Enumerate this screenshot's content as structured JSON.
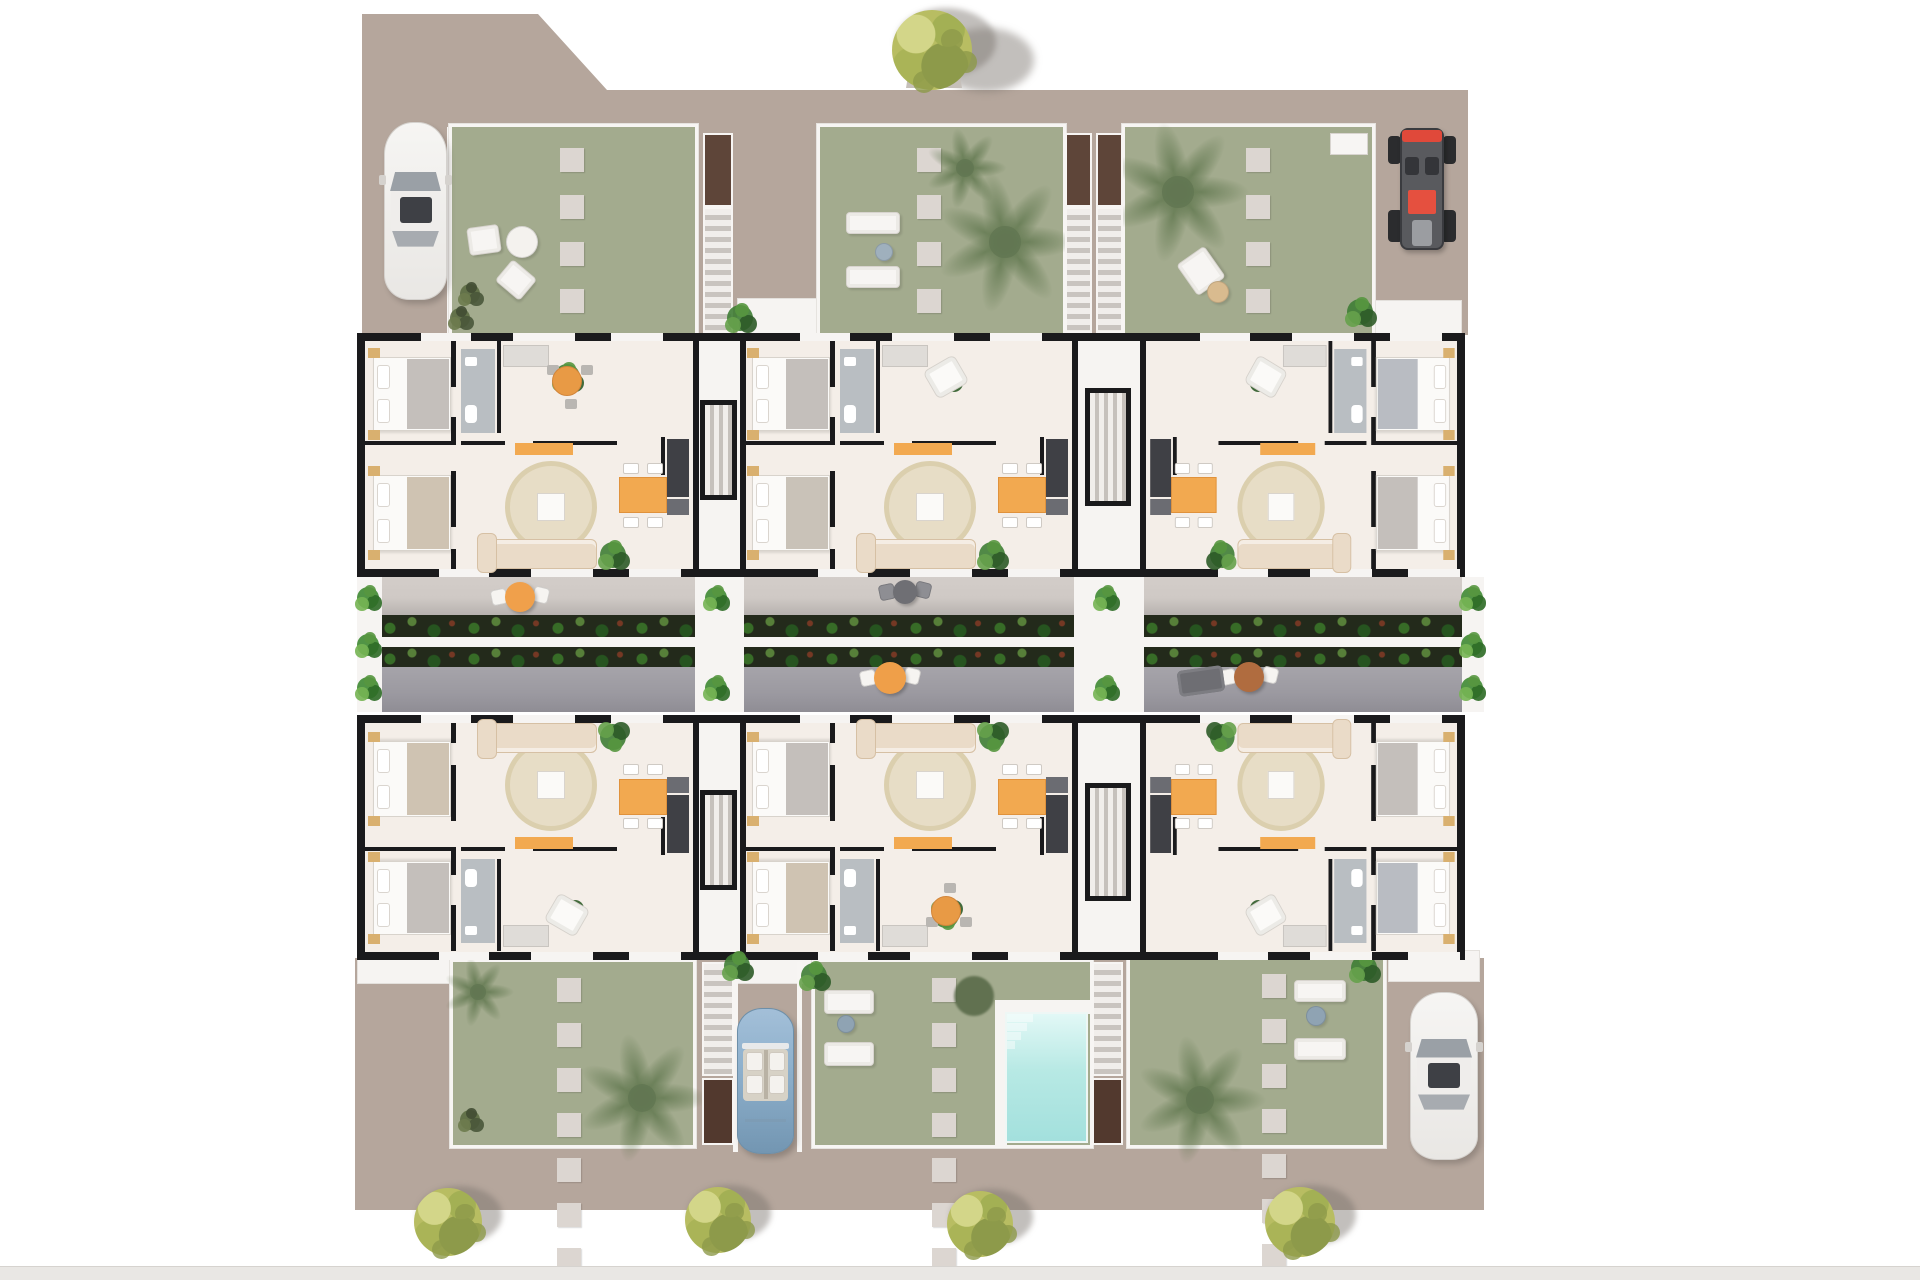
{
  "meta": {
    "type": "architectural-floor-plan-render",
    "canvas_w": 1920,
    "canvas_h": 1280,
    "description": "Top-down 3D render of a residential block with six apartments in two rows, a central terrace corridor with planters, private gardens with stepping stones, staircases, a swimming pool, parked cars and trees"
  },
  "palette": {
    "page": "#ffffff",
    "ground": "#b5a69c",
    "wall": "#1a1a1c",
    "floor": "#f4eee8",
    "gardenGreen": "#949e7c",
    "gardenWash": "rgba(255,255,255,0.14)",
    "stone": "#dcd6d1",
    "white": "#f7f5f3",
    "terraceLight": "#cfc9c5",
    "terraceLightShadow": "#b7b2af",
    "terraceDark": "#9b99a0",
    "walkway": "#f6f4f2",
    "brownTop": "#5e4539",
    "brownBottom": "#52392e",
    "poolLight": "#e2f8f6",
    "pool": "#b7e9e4",
    "poolDeep": "#a3e0dd",
    "rug": "#e7ddc6",
    "rugEdge": "#dbcfae",
    "orange": "#f2a950",
    "orangeDeep": "#e0923c",
    "sofa": "#eadbc8",
    "sofaEdge": "#d6c0a4",
    "bath": "#b9bec2",
    "kitchenDark": "#3f4045",
    "kitchenMid": "#6b6c72",
    "bedWhite": "#fbfaf8",
    "bedTrim": "#d8d3cc",
    "nightstand": "#d9b06f",
    "wardrobe": "#dfdcd8",
    "plantDark": "#2e5b28",
    "plant": "#3f7d35",
    "plantLight": "#66a14b",
    "plantOlive": "#5c6b43",
    "palm": "#5d7a4d",
    "treeYellow": "#b8bd62",
    "treeOlive": "#8d9a4a",
    "treeLight": "#d3d689",
    "shadow": "rgba(120,114,106,0.45)",
    "carWhite": "#f3f2f0",
    "carTrim": "#d5d2ce",
    "glass": "#9aa0a6",
    "glassDark": "#3e4045",
    "carBlue": "#8fb1cd",
    "carBlueDark": "#7396b2",
    "cabin": "#d7d2c6",
    "buggyRed": "#e0493a",
    "buggyDark": "#595a5e",
    "tyre": "#2b2c2e",
    "bar": "#e9e7e4",
    "barEdge": "#d6d3cf"
  },
  "scene": {
    "ground": {
      "top": {
        "x": 362,
        "y": 14,
        "w": 1106,
        "h": 321,
        "clip": [
          [
            0,
            0
          ],
          [
            176,
            0
          ],
          [
            245,
            76
          ],
          [
            1106,
            76
          ],
          [
            1106,
            321
          ],
          [
            0,
            321
          ]
        ]
      },
      "bottom": {
        "x": 355,
        "y": 958,
        "w": 1129,
        "h": 252
      }
    },
    "bottom_bar": {
      "x": 0,
      "y": 1266,
      "w": 1920,
      "h": 14
    },
    "top_tree": {
      "x": 932,
      "y": 50,
      "r": 40,
      "planter": {
        "x": 906,
        "y": 26,
        "w": 56,
        "h": 62
      }
    },
    "bottom_trees": [
      [
        448,
        1222,
        34
      ],
      [
        718,
        1220,
        33
      ],
      [
        980,
        1224,
        33
      ],
      [
        1300,
        1222,
        35
      ]
    ],
    "gardens": [
      {
        "name": "garden-top-left",
        "x": 452,
        "y": 127,
        "w": 243,
        "h": 206,
        "stones": {
          "x": 560,
          "y0": 148,
          "n": 8,
          "size": 24,
          "gap": 23
        },
        "items": [
          {
            "t": "lounger",
            "x": 468,
            "y": 226,
            "w": 32,
            "h": 28,
            "rot": -8
          },
          {
            "t": "tableRound",
            "x": 522,
            "y": 242,
            "r": 16,
            "c": "#f4f2ee"
          },
          {
            "t": "lounger",
            "x": 500,
            "y": 266,
            "w": 32,
            "h": 28,
            "rot": 40
          },
          {
            "t": "plantDark",
            "x": 470,
            "y": 294
          },
          {
            "t": "plantDark",
            "x": 460,
            "y": 318
          }
        ]
      },
      {
        "name": "garden-top-middle",
        "x": 820,
        "y": 127,
        "w": 243,
        "h": 206,
        "stones": {
          "x": 917,
          "y0": 148,
          "n": 8,
          "size": 24,
          "gap": 23
        },
        "items": [
          {
            "t": "lounger",
            "x": 846,
            "y": 212,
            "w": 54,
            "h": 22,
            "rot": 0
          },
          {
            "t": "lounger",
            "x": 846,
            "y": 266,
            "w": 54,
            "h": 22,
            "rot": 0
          },
          {
            "t": "tableRound",
            "x": 884,
            "y": 252,
            "r": 9,
            "c": "#9fb0bd"
          },
          {
            "t": "palm",
            "x": 1005,
            "y": 242,
            "r": 52
          },
          {
            "t": "palm",
            "x": 965,
            "y": 168,
            "r": 30
          }
        ]
      },
      {
        "name": "garden-top-right",
        "x": 1125,
        "y": 127,
        "w": 247,
        "h": 206,
        "stones": {
          "x": 1246,
          "y0": 148,
          "n": 8,
          "size": 24,
          "gap": 23
        },
        "items": [
          {
            "t": "palm",
            "x": 1178,
            "y": 192,
            "r": 52
          },
          {
            "t": "lounger",
            "x": 1184,
            "y": 252,
            "w": 34,
            "h": 38,
            "rot": -35
          },
          {
            "t": "tableRound",
            "x": 1218,
            "y": 292,
            "r": 11,
            "c": "#d9bb8f"
          },
          {
            "t": "box",
            "x": 1330,
            "y": 133,
            "w": 38,
            "h": 22
          }
        ]
      },
      {
        "name": "garden-bottom-left",
        "x": 453,
        "y": 962,
        "w": 240,
        "h": 183,
        "stones": {
          "x": 557,
          "y0": 978,
          "n": 8,
          "size": 24,
          "gap": 21
        },
        "items": [
          {
            "t": "palm",
            "x": 478,
            "y": 992,
            "r": 26
          },
          {
            "t": "palm",
            "x": 642,
            "y": 1098,
            "r": 48
          },
          {
            "t": "plantDark",
            "x": 470,
            "y": 1120
          }
        ]
      },
      {
        "name": "garden-bottom-middle",
        "x": 815,
        "y": 962,
        "w": 275,
        "h": 183,
        "stones": {
          "x": 932,
          "y0": 978,
          "n": 8,
          "size": 24,
          "gap": 21
        },
        "items": [
          {
            "t": "plant",
            "x": 814,
            "y": 976
          },
          {
            "t": "lounger",
            "x": 824,
            "y": 990,
            "w": 50,
            "h": 24,
            "rot": 0
          },
          {
            "t": "lounger",
            "x": 824,
            "y": 1042,
            "w": 50,
            "h": 24,
            "rot": 0
          },
          {
            "t": "tableRound",
            "x": 846,
            "y": 1024,
            "r": 9,
            "c": "#8fa3b3"
          },
          {
            "t": "palmDarkBlob",
            "x": 974,
            "y": 996,
            "r": 20
          }
        ]
      },
      {
        "name": "garden-bottom-right",
        "x": 1130,
        "y": 958,
        "w": 253,
        "h": 187,
        "stones": {
          "x": 1262,
          "y0": 974,
          "n": 8,
          "size": 24,
          "gap": 21
        },
        "items": [
          {
            "t": "lounger",
            "x": 1294,
            "y": 980,
            "w": 52,
            "h": 22,
            "rot": 0
          },
          {
            "t": "lounger",
            "x": 1294,
            "y": 1038,
            "w": 52,
            "h": 22,
            "rot": 0
          },
          {
            "t": "tableRound",
            "x": 1316,
            "y": 1016,
            "r": 10,
            "c": "#8fa3b3"
          },
          {
            "t": "palm",
            "x": 1200,
            "y": 1100,
            "r": 48
          },
          {
            "t": "plant",
            "x": 1364,
            "y": 968
          }
        ]
      }
    ],
    "stairs": [
      {
        "name": "stairs-top-1",
        "x": 703,
        "w": 30,
        "brown": {
          "y": 133,
          "h": 74
        },
        "treads": {
          "y": 207,
          "h": 126
        },
        "tone": "top"
      },
      {
        "name": "stairs-top-2",
        "x": 1065,
        "w": 27,
        "brown": {
          "y": 133,
          "h": 74
        },
        "treads": {
          "y": 207,
          "h": 126
        },
        "tone": "top"
      },
      {
        "name": "stairs-top-3",
        "x": 1096,
        "w": 27,
        "brown": {
          "y": 133,
          "h": 74
        },
        "treads": {
          "y": 207,
          "h": 126
        },
        "tone": "top"
      },
      {
        "name": "stairs-bottom-1",
        "x": 702,
        "w": 32,
        "treads": {
          "y": 962,
          "h": 114
        },
        "brown": {
          "y": 1078,
          "h": 67
        },
        "tone": "bottom"
      },
      {
        "name": "stairs-bottom-2",
        "x": 1092,
        "w": 31,
        "treads": {
          "y": 962,
          "h": 114
        },
        "brown": {
          "y": 1078,
          "h": 67
        },
        "tone": "bottom"
      }
    ],
    "pool": {
      "x": 1005,
      "y": 1012,
      "w": 83,
      "h": 131
    },
    "pool_deck": [
      [
        995,
        1000,
        95,
        14
      ],
      [
        995,
        1000,
        12,
        147
      ]
    ],
    "walkways": [
      [
        357,
        948,
        95,
        36
      ],
      [
        737,
        950,
        80,
        34
      ],
      [
        1388,
        950,
        92,
        32
      ],
      [
        737,
        298,
        82,
        36
      ],
      [
        1374,
        300,
        88,
        34
      ]
    ],
    "walkway_plants": [
      [
        740,
        318
      ],
      [
        737,
        966
      ],
      [
        1360,
        312
      ]
    ],
    "drive_walls": [
      [
        733,
        962,
        5,
        190
      ],
      [
        797,
        962,
        5,
        190
      ],
      [
        447,
        127,
        6,
        206
      ]
    ],
    "terrace": {
      "x": 357,
      "w": 1108,
      "light": {
        "y": 577,
        "h": 38
      },
      "planterA": {
        "y": 615,
        "h": 22
      },
      "walk": {
        "y": 637,
        "h": 10
      },
      "planterB": {
        "y": 647,
        "h": 20
      },
      "dark": {
        "y": 667,
        "h": 45
      },
      "planter_spans": [
        [
          382,
          695
        ],
        [
          740,
          1074
        ],
        [
          1144,
          1462
        ]
      ],
      "white_cols": [
        [
          357,
          25
        ],
        [
          695,
          49
        ],
        [
          1074,
          70
        ],
        [
          1462,
          22
        ]
      ],
      "col_plants": [
        [
          368,
          598
        ],
        [
          368,
          645
        ],
        [
          368,
          688
        ],
        [
          716,
          598
        ],
        [
          716,
          688
        ],
        [
          1106,
          598
        ],
        [
          1106,
          688
        ],
        [
          1472,
          598
        ],
        [
          1472,
          645
        ],
        [
          1472,
          688
        ]
      ],
      "bistros": [
        {
          "x": 520,
          "y": 597,
          "table": "#f0a04b",
          "chair": "#f6f4f1",
          "r": 15
        },
        {
          "x": 905,
          "y": 592,
          "table": "#6f6f74",
          "chair": "#8e8e93",
          "r": 12
        },
        {
          "x": 890,
          "y": 678,
          "table": "#ef9f49",
          "chair": "#f6f4f1",
          "r": 16
        },
        {
          "x": 1249,
          "y": 677,
          "table": "#b06c3f",
          "chair": "#f6f4f1",
          "r": 15
        }
      ],
      "lounges": [
        {
          "x": 1178,
          "y": 668,
          "w": 46,
          "h": 26,
          "rot": -8
        }
      ]
    },
    "bands": [
      {
        "name": "apartment-band-upper",
        "x": 357,
        "y": 333,
        "w": 1108,
        "h": 244
      },
      {
        "name": "apartment-band-lower",
        "x": 357,
        "y": 715,
        "w": 1108,
        "h": 245
      }
    ],
    "cores": [
      {
        "band": 0,
        "x": 695,
        "w": 49,
        "shaft": {
          "x": 700,
          "y": 400,
          "w": 37,
          "h": 100
        }
      },
      {
        "band": 0,
        "x": 1074,
        "w": 70,
        "shaft": {
          "x": 1085,
          "y": 388,
          "w": 46,
          "h": 118
        }
      },
      {
        "band": 1,
        "x": 695,
        "w": 49,
        "shaft": {
          "x": 700,
          "y": 790,
          "w": 37,
          "h": 100
        }
      },
      {
        "band": 1,
        "x": 1074,
        "w": 70,
        "shaft": {
          "x": 1085,
          "y": 783,
          "w": 46,
          "h": 118
        }
      }
    ],
    "door_gap_offsets": [
      [
        56,
        50
      ],
      [
        148,
        62
      ],
      [
        246,
        52
      ]
    ],
    "units": [
      {
        "name": "unit-top-left",
        "x": 365,
        "y": 341,
        "w": 330,
        "h": 228,
        "flip": "none",
        "terrace": "round-table",
        "blanket1": "#c4bfbb",
        "blanket2": "#cfc3b2"
      },
      {
        "name": "unit-top-middle",
        "x": 744,
        "y": 341,
        "w": 330,
        "h": 228,
        "flip": "none",
        "terrace": "armchair",
        "blanket1": "#c4bfbb",
        "blanket2": "#c9c2b8"
      },
      {
        "name": "unit-top-right",
        "x": 1144,
        "y": 341,
        "w": 313,
        "h": 228,
        "flip": "x",
        "terrace": "armchair",
        "blanket1": "#b9bcc2",
        "blanket2": "#c4bfbb"
      },
      {
        "name": "unit-bottom-left",
        "x": 365,
        "y": 723,
        "w": 330,
        "h": 228,
        "flip": "y",
        "terrace": "armchair",
        "blanket1": "#c4bfbb",
        "blanket2": "#cfc3b2"
      },
      {
        "name": "unit-bottom-middle",
        "x": 744,
        "y": 723,
        "w": 330,
        "h": 228,
        "flip": "y",
        "terrace": "round-table",
        "blanket1": "#cfc3b2",
        "blanket2": "#c4bfbb"
      },
      {
        "name": "unit-bottom-right",
        "x": 1144,
        "y": 723,
        "w": 313,
        "h": 228,
        "flip": "xy",
        "terrace": "armchair",
        "blanket1": "#b9bcc2",
        "blanket2": "#c4bfbb"
      }
    ],
    "cars": [
      {
        "kind": "sedan",
        "name": "white-car-top-left",
        "x": 384,
        "y": 122,
        "w": 63,
        "h": 178
      },
      {
        "kind": "cabrio",
        "name": "blue-convertible-car",
        "x": 737,
        "y": 1008,
        "w": 57,
        "h": 146
      },
      {
        "kind": "sedan",
        "name": "white-car-bottom-right",
        "x": 1410,
        "y": 992,
        "w": 68,
        "h": 168
      },
      {
        "kind": "buggy",
        "name": "red-buggy",
        "x": 1388,
        "y": 122,
        "w": 68,
        "h": 136
      }
    ]
  }
}
